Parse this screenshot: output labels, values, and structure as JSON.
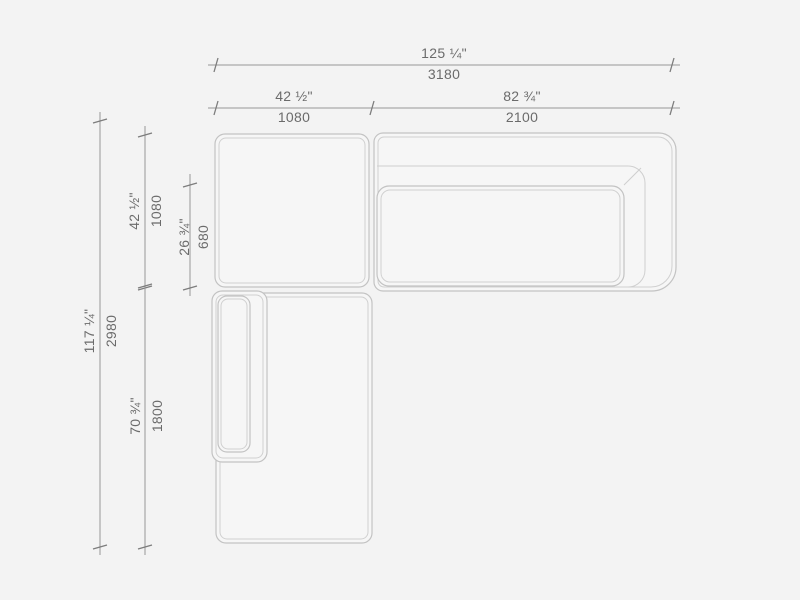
{
  "drawing": {
    "title": "sectional-sofa-top-view-dimension-drawing",
    "colors": {
      "background": "#f3f3f3",
      "dimension_line": "#979797",
      "dimension_text": "#6b6b6b",
      "sofa_outline": "#c3c3c3",
      "sofa_inner_outline": "#d0d0d0",
      "sofa_fill": "#f6f6f6"
    },
    "dims": {
      "overall_width": {
        "inches": "125 ¼\"",
        "mm": "3180"
      },
      "top_left_width": {
        "inches": "42 ½\"",
        "mm": "1080"
      },
      "top_right_width": {
        "inches": "82 ¾\"",
        "mm": "2100"
      },
      "overall_height": {
        "inches": "117 ¼\"",
        "mm": "2980"
      },
      "upper_height": {
        "inches": "42 ½\"",
        "mm": "1080"
      },
      "seat_depth": {
        "inches": "26 ¾\"",
        "mm": "680"
      },
      "lower_height": {
        "inches": "70 ¾\"",
        "mm": "1800"
      }
    }
  }
}
